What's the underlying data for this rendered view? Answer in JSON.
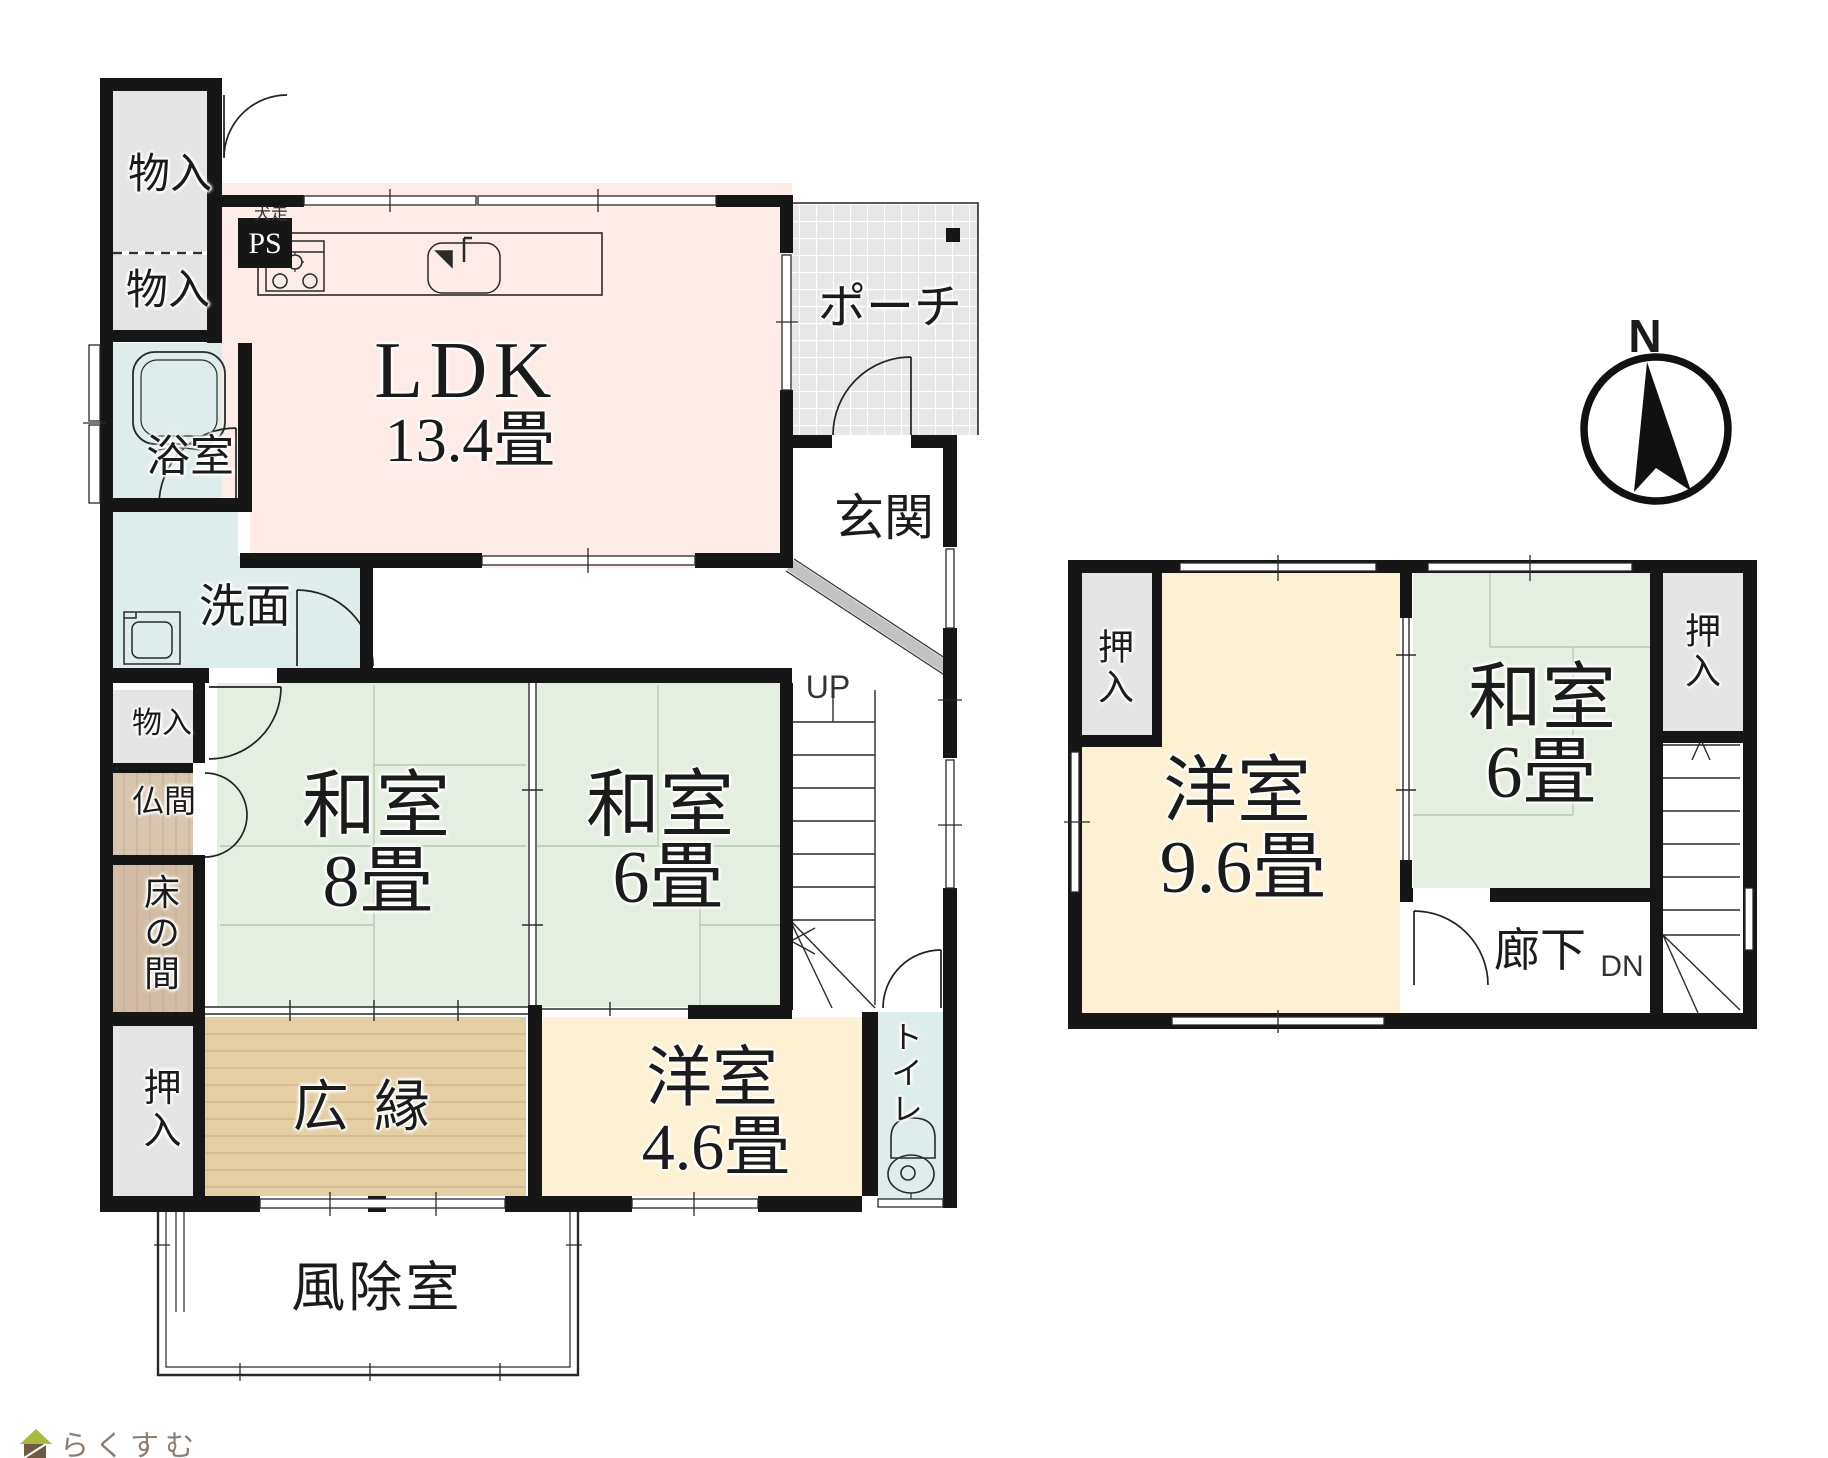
{
  "floor1": {
    "storage_top": "物入",
    "storage_mid": "物入",
    "bath": "浴室",
    "washroom": "洗面",
    "inubashiri": "犬走",
    "pipe_space": "PS",
    "ldk": {
      "name": "LDK",
      "size": "13.4畳"
    },
    "porch": "ポーチ",
    "entrance": "玄関",
    "storage_small": "物入",
    "butsuma": "仏間",
    "tokonoma": "床の間",
    "washitsu8": {
      "name": "和室",
      "size": "8畳"
    },
    "washitsu6": {
      "name": "和室",
      "size": "6畳"
    },
    "stairs_up": "UP",
    "oshiire": "押入",
    "hiroen": "広縁",
    "youshitsu46": {
      "name": "洋室",
      "size": "4.6畳"
    },
    "toilet": "トイレ",
    "windbreak": "風除室"
  },
  "floor2": {
    "oshiire_left": "押入",
    "youshitsu96": {
      "name": "洋室",
      "size": "9.6畳"
    },
    "washitsu6": {
      "name": "和室",
      "size": "6畳"
    },
    "oshiire_right": "押入",
    "hallway": "廊下",
    "stairs_down": "DN"
  },
  "compass": {
    "north": "N"
  },
  "logo": {
    "text": "らくすむ"
  },
  "palette": {
    "wall": "#161616",
    "tatami": "#e5efe1",
    "tatami_line": "#b5c9b1",
    "wood_veranda": "#e4cfa5",
    "wood_alcove": "#d5c1aa",
    "western_room": "#fcf1d2",
    "wet_room": "#dfecec",
    "ldk_pink": "#fcebe6",
    "storage_gray": "#e4e4e4",
    "porch_tile": "#e7e7e7"
  }
}
